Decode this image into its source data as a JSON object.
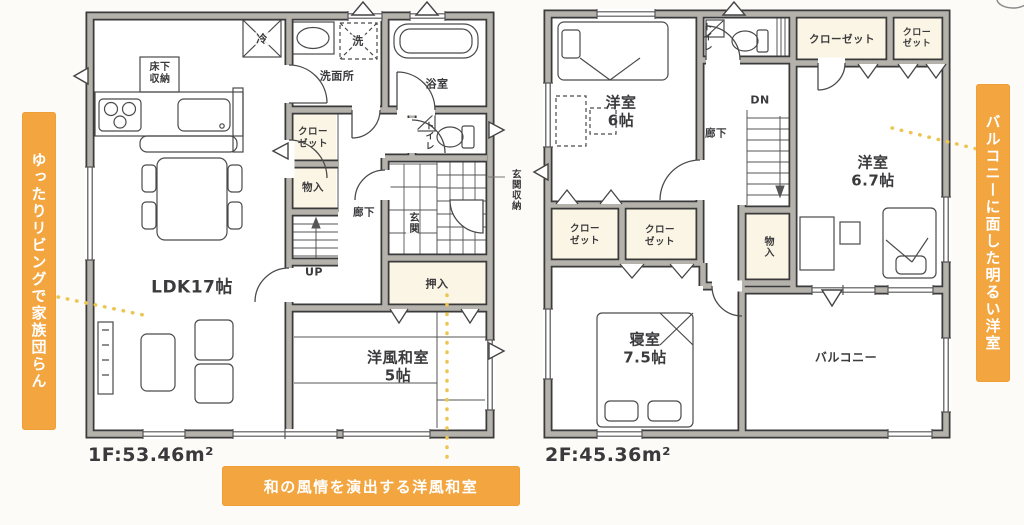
{
  "floor1": {
    "area": "1F:53.46m²",
    "labels": {
      "ldk": "LDK17帖",
      "washitsu": "洋風和室\n5帖",
      "yukashita": "床下\n収納",
      "rei": "冷",
      "sen": "洗",
      "senmenjo": "洗面所",
      "yokushitsu": "浴室",
      "closet": "クロー\nゼット",
      "monoire": "物入",
      "rouka": "廊下",
      "up": "UP",
      "toilet": "トイレ",
      "genkan": "玄関",
      "genkan_shuno": "玄関収納",
      "oshiire": "押入"
    }
  },
  "floor2": {
    "area": "2F:45.36m²",
    "labels": {
      "toilet": "トイレ",
      "closet_wide": "クローゼット",
      "closet_small": "クロー\nゼット",
      "yoshitsu6": "洋室\n6帖",
      "dn": "DN",
      "rouka": "廊下",
      "yoshitsu67": "洋室\n6.7帖",
      "closet_a": "クロー\nゼット",
      "closet_b": "クロー\nゼット",
      "monoire": "物入",
      "shinshitsu": "寝室\n7.5帖",
      "balcony": "バルコニー"
    }
  },
  "callouts": {
    "left": "ゆったりリビングで家族団らん",
    "right": "バルコニーに面した明るい洋室",
    "bottom": "和の風情を演出する洋風和室"
  },
  "colors": {
    "banner_orange": "#f3a53f",
    "dotted_yellow": "#ecc653",
    "wall_gray": "#b5b2ac"
  }
}
